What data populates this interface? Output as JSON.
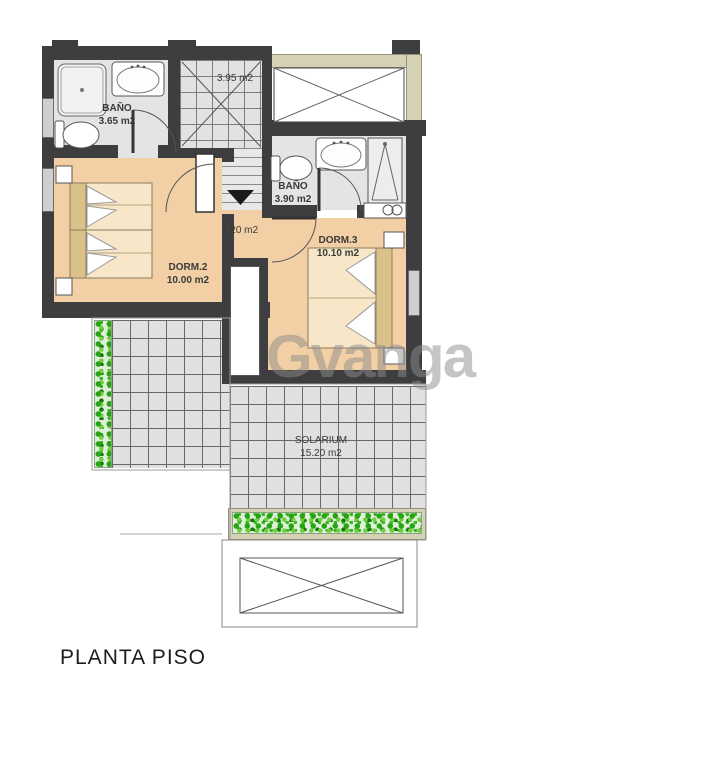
{
  "title": "PLANTA PISO",
  "watermark": "Gvanga",
  "rooms": {
    "bath1": {
      "name": "BAÑO",
      "area": "3.65 m2"
    },
    "stairs": {
      "area": "3.95 m2"
    },
    "bath2": {
      "name": "BAÑO",
      "area": "3.90 m2"
    },
    "hall": {
      "area": "1.20 m2"
    },
    "dorm2": {
      "name": "DORM.2",
      "area": "10.00 m2"
    },
    "dorm3": {
      "name": "DORM.3",
      "area": "10.10 m2"
    },
    "solarium": {
      "name": "SOLARIUM",
      "area": "15.20 m2"
    }
  },
  "colors": {
    "wall": "#3e3e40",
    "bedroom_floor": "#f2cfa4",
    "bed_fill": "#f7e6c8",
    "bed_head": "#d9c189",
    "tile": "#e2e2e4",
    "roof_band": "#d5d1b4",
    "planter_green": "#27a315",
    "watermark_gray": "#8c8c8c"
  }
}
